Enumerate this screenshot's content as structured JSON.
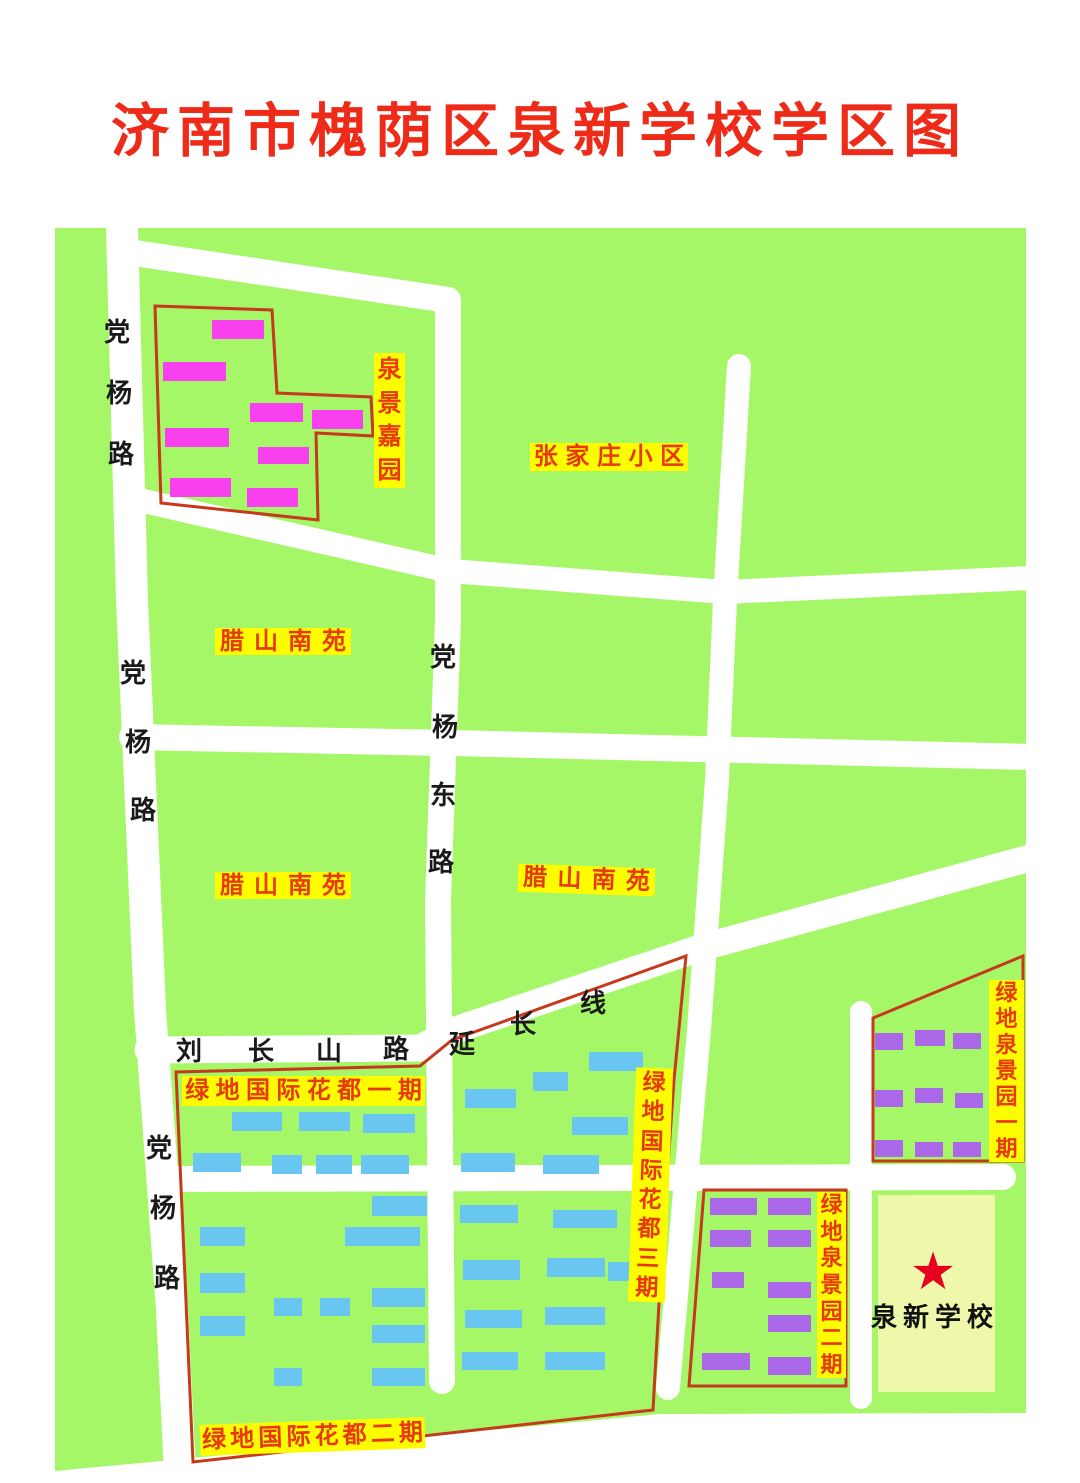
{
  "title": "济南市槐荫区泉新学校学区图",
  "colors": {
    "green": "#a6f768",
    "road": "#ffffff",
    "yellow": "#fdfd00",
    "label-red": "#e8380d",
    "outline-red": "#c5391d",
    "title-red": "#ee2a18",
    "road-text": "#1a1a1a",
    "star-red": "#e8001f",
    "school-yard": "#eff7ab",
    "school-text": "#111111",
    "magenta": "#f840ee",
    "blue": "#68c6f0",
    "purple": "#aa67e8"
  },
  "map": {
    "area_labels": [
      {
        "name": "zhangjiazhuang-xiaoqu",
        "text": "张家庄小区",
        "x": 530,
        "y": 443,
        "w": 158,
        "h": 28,
        "dir": "h",
        "fs": 24
      },
      {
        "name": "lashan-nanyuan-1",
        "text": "腊山南苑",
        "x": 215,
        "y": 628,
        "w": 136,
        "h": 27,
        "dir": "h",
        "fs": 24
      },
      {
        "name": "lashan-nanyuan-2",
        "text": "腊山南苑",
        "x": 215,
        "y": 872,
        "w": 136,
        "h": 27,
        "dir": "h",
        "fs": 24
      },
      {
        "name": "lashan-nanyuan-3",
        "text": "腊山南苑",
        "x": 518,
        "y": 866,
        "w": 137,
        "h": 28,
        "dir": "h",
        "fs": 24,
        "rot": 2
      },
      {
        "name": "lvdi-guoji-huadu-1",
        "text": "绿地国际花都一期",
        "x": 182,
        "y": 1076,
        "w": 243,
        "h": 30,
        "dir": "h",
        "fs": 24
      },
      {
        "name": "lvdi-guoji-huadu-2",
        "text": "绿地国际花都二期",
        "x": 200,
        "y": 1421,
        "w": 225,
        "h": 31,
        "dir": "h",
        "fs": 24,
        "rot": -2
      },
      {
        "name": "lvdi-guoji-huadu-3",
        "text": "绿地国际花都三期",
        "x": 632,
        "y": 1068,
        "w": 37,
        "h": 234,
        "dir": "v",
        "fs": 23,
        "rot": 2
      },
      {
        "name": "quanjing-jiayuan",
        "text": "泉景嘉园",
        "x": 374,
        "y": 353,
        "w": 31,
        "h": 135,
        "dir": "v",
        "fs": 24
      },
      {
        "name": "lvdi-quanjingyuan-1",
        "text": "绿地泉景园一期",
        "x": 989,
        "y": 980,
        "w": 35,
        "h": 182,
        "dir": "v",
        "fs": 22
      },
      {
        "name": "lvdi-quanjingyuan-2",
        "text": "绿地泉景园二期",
        "x": 817,
        "y": 1192,
        "w": 29,
        "h": 186,
        "dir": "v",
        "fs": 22
      }
    ],
    "road_labels": [
      {
        "name": "dangyang-road-1",
        "text": "党杨路",
        "chars": [
          [
            117,
            332
          ],
          [
            119,
            393
          ],
          [
            121,
            454
          ]
        ]
      },
      {
        "name": "dangyang-road-2",
        "text": "党杨路",
        "chars": [
          [
            133,
            673
          ],
          [
            138,
            742
          ],
          [
            143,
            810
          ]
        ]
      },
      {
        "name": "dangyang-road-3",
        "text": "党杨路",
        "chars": [
          [
            159,
            1148
          ],
          [
            163,
            1208
          ],
          [
            167,
            1278
          ]
        ]
      },
      {
        "name": "dangyang-east-road",
        "text": "党杨东路",
        "chars": [
          [
            443,
            657
          ],
          [
            445,
            727
          ],
          [
            443,
            795
          ],
          [
            441,
            862
          ]
        ]
      },
      {
        "name": "liuchangshan-road-extension",
        "text": "刘长山路延长线",
        "chars": [
          [
            189,
            1051
          ],
          [
            261,
            1051
          ],
          [
            329,
            1051
          ],
          [
            396,
            1049
          ],
          [
            462,
            1044
          ],
          [
            523,
            1024
          ],
          [
            593,
            1003
          ]
        ]
      }
    ],
    "school": {
      "name": "泉新学校",
      "label_x": 935,
      "label_y": 1313,
      "star_x": 933,
      "star_y": 1272,
      "yard": [
        878,
        1195,
        117,
        197
      ]
    },
    "building_groups": [
      {
        "name": "quanjing-jiayuan-building",
        "color": "magenta",
        "rects": [
          [
            212,
            320,
            52,
            19
          ],
          [
            163,
            362,
            63,
            19
          ],
          [
            250,
            403,
            53,
            19
          ],
          [
            312,
            410,
            51,
            19
          ],
          [
            165,
            428,
            64,
            19
          ],
          [
            258,
            447,
            51,
            17
          ],
          [
            170,
            478,
            61,
            19
          ],
          [
            247,
            488,
            51,
            19
          ]
        ]
      },
      {
        "name": "lvdi-guoji-huadu-building",
        "color": "blue",
        "rects": [
          [
            232,
            1112,
            50,
            19
          ],
          [
            299,
            1112,
            51,
            19
          ],
          [
            363,
            1114,
            52,
            19
          ],
          [
            193,
            1153,
            48,
            19
          ],
          [
            272,
            1155,
            30,
            19
          ],
          [
            316,
            1155,
            36,
            19
          ],
          [
            361,
            1155,
            48,
            19
          ],
          [
            465,
            1089,
            51,
            19
          ],
          [
            533,
            1072,
            35,
            19
          ],
          [
            589,
            1052,
            54,
            19
          ],
          [
            461,
            1153,
            54,
            19
          ],
          [
            543,
            1155,
            56,
            19
          ],
          [
            572,
            1117,
            56,
            18
          ],
          [
            200,
            1227,
            45,
            19
          ],
          [
            345,
            1227,
            75,
            19
          ],
          [
            200,
            1273,
            45,
            20
          ],
          [
            274,
            1298,
            28,
            18
          ],
          [
            320,
            1298,
            30,
            18
          ],
          [
            200,
            1316,
            45,
            20
          ],
          [
            372,
            1196,
            55,
            20
          ],
          [
            372,
            1288,
            53,
            19
          ],
          [
            372,
            1325,
            53,
            18
          ],
          [
            274,
            1368,
            28,
            18
          ],
          [
            372,
            1368,
            53,
            18
          ],
          [
            460,
            1205,
            58,
            18
          ],
          [
            463,
            1260,
            57,
            20
          ],
          [
            465,
            1310,
            57,
            18
          ],
          [
            462,
            1352,
            56,
            18
          ],
          [
            553,
            1210,
            64,
            18
          ],
          [
            547,
            1258,
            58,
            19
          ],
          [
            608,
            1262,
            37,
            19
          ],
          [
            545,
            1307,
            60,
            18
          ],
          [
            545,
            1352,
            60,
            18
          ]
        ]
      },
      {
        "name": "lvdi-quanjingyuan-1-building",
        "color": "purple",
        "rects": [
          [
            875,
            1033,
            28,
            17
          ],
          [
            915,
            1030,
            30,
            16
          ],
          [
            953,
            1033,
            28,
            16
          ],
          [
            875,
            1090,
            28,
            17
          ],
          [
            915,
            1088,
            28,
            15
          ],
          [
            955,
            1093,
            28,
            15
          ],
          [
            875,
            1140,
            28,
            17
          ],
          [
            915,
            1142,
            28,
            15
          ],
          [
            953,
            1142,
            28,
            15
          ]
        ]
      },
      {
        "name": "lvdi-quanjingyuan-2-building",
        "color": "purple",
        "rects": [
          [
            710,
            1198,
            47,
            17
          ],
          [
            768,
            1198,
            43,
            17
          ],
          [
            710,
            1230,
            41,
            17
          ],
          [
            768,
            1230,
            43,
            17
          ],
          [
            712,
            1272,
            32,
            16
          ],
          [
            768,
            1282,
            43,
            16
          ],
          [
            768,
            1315,
            43,
            17
          ],
          [
            702,
            1353,
            48,
            17
          ],
          [
            768,
            1357,
            43,
            18
          ]
        ]
      }
    ]
  }
}
